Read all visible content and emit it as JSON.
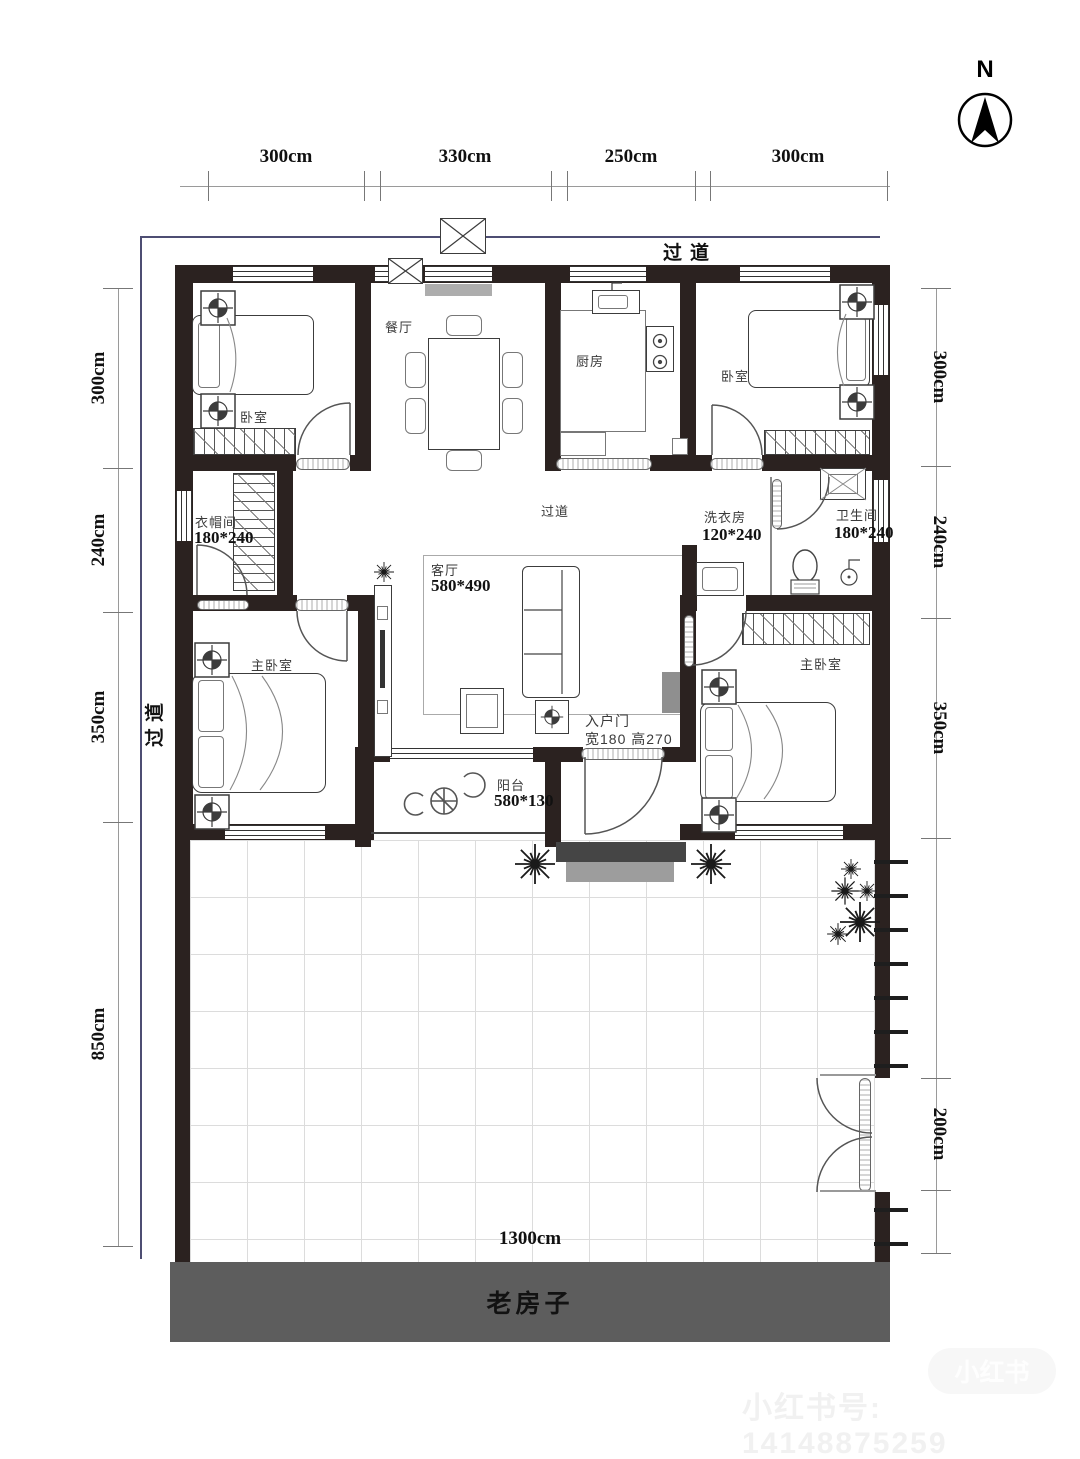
{
  "compass": "N",
  "dims": {
    "top": [
      "300cm",
      "330cm",
      "250cm",
      "300cm"
    ],
    "left": [
      "300cm",
      "240cm",
      "350cm",
      "850cm"
    ],
    "right": [
      "300cm",
      "240cm",
      "350cm",
      "200cm"
    ],
    "bottom": "1300cm"
  },
  "corridors": {
    "top": "过道",
    "left": "过道"
  },
  "rooms": {
    "bedroom_tl": "卧室",
    "dining": "餐厅",
    "kitchen": "厨房",
    "bedroom_tr": "卧室",
    "cloakroom": "衣帽间",
    "hall": "过道",
    "laundry": "洗衣房",
    "bath": "卫生间",
    "master_left": "主卧室",
    "living": "客厅",
    "master_right": "主卧室",
    "balcony": "阳台",
    "entry": "入户门"
  },
  "sizes": {
    "cloakroom": "180*240",
    "laundry": "120*240",
    "bath": "180*240",
    "living": "580*490",
    "balcony": "580*130",
    "entry": "宽180 高270"
  },
  "footer": {
    "old_house": "老房子"
  },
  "watermark": {
    "badge": "小红书",
    "text": "小红书号: 14148875259"
  },
  "colors": {
    "wall": "#2b2220",
    "boundary": "#4e4e73",
    "old_house_band": "#5d5d5d"
  }
}
